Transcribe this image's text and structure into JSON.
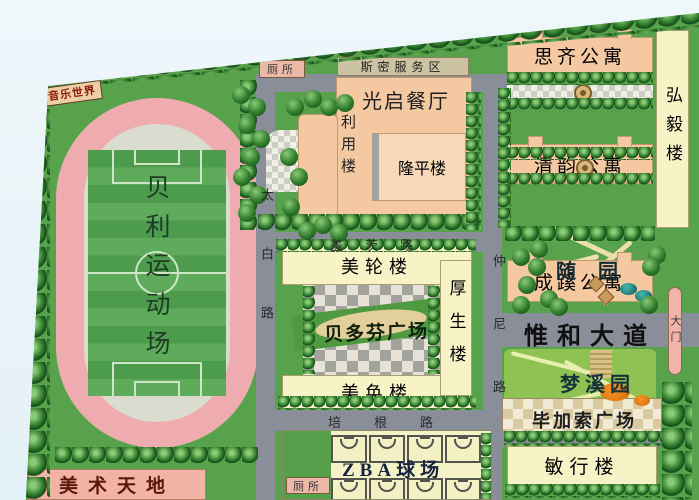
{
  "stadium": {
    "field_name": "贝利运动场",
    "music_world": "音乐世界"
  },
  "dining_block": {
    "service_banner": "斯密服务区",
    "dining_hall": "光启餐厅",
    "liyong_building": "利用楼",
    "longping_building": "隆平楼"
  },
  "apartments": {
    "siqi": "思齐公寓",
    "qingyun": "清韵公寓",
    "chengxi": "成蹊公寓",
    "hongyi_building": "弘毅楼"
  },
  "teaching": {
    "meilun_building": "美轮楼",
    "meihuan_building": "美奂楼",
    "housheng_building": "厚生楼",
    "beethoven_square": "贝多芬广场"
  },
  "gardens": {
    "sui_garden": "随园",
    "mengxi_garden": "梦溪园",
    "picasso_square": "毕加索广场"
  },
  "south": {
    "minxing_building": "敏行楼",
    "zba_courts": "ZBA球场",
    "art_world": "美术天地"
  },
  "roads": {
    "taibai_road": "太白路",
    "zhongni_road": "仲尼路",
    "gates_road": "盖茨路",
    "bacon_road": "培根路",
    "weihe_avenue": "惟和大道",
    "main_gate": "大门"
  },
  "facilities": {
    "toilet_north": "厕所",
    "toilet_south": "厕所"
  },
  "colors": {
    "campus_green": "#58a24c",
    "track_pink": "#eeacae",
    "road_gray": "#8a8e98",
    "building_peach": "#f4c9a1",
    "building_cream": "#f7f3c6",
    "building_pink": "#f1b4a4",
    "tree_dark_green": "#2f7c2c"
  }
}
